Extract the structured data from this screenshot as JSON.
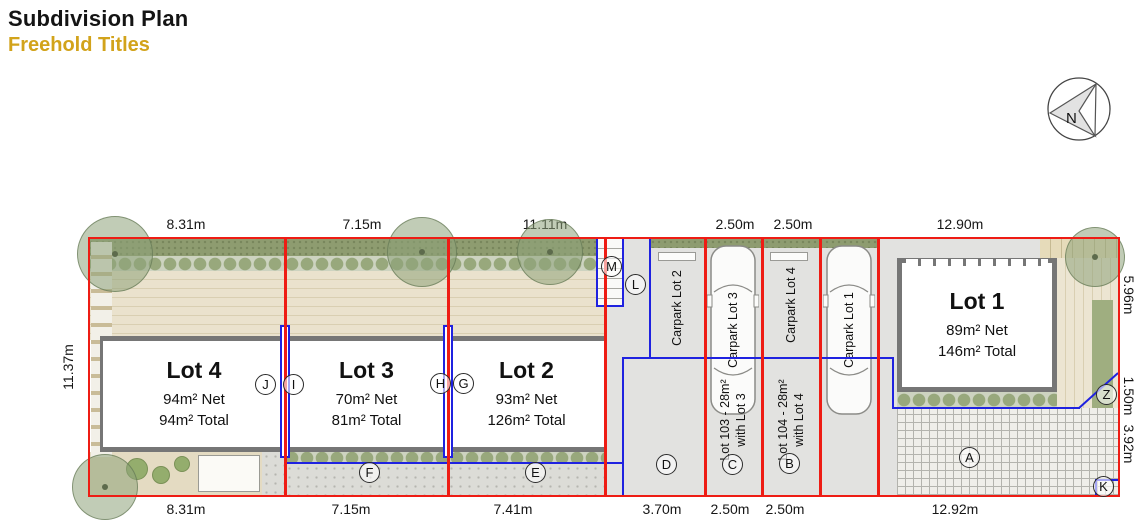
{
  "header": {
    "title": "Subdivision Plan",
    "subtitle": "Freehold Titles"
  },
  "compass": {
    "label": "N"
  },
  "dimensions": {
    "top": [
      "8.31m",
      "7.15m",
      "11.11m",
      "2.50m",
      "2.50m",
      "12.90m"
    ],
    "bottom": [
      "8.31m",
      "7.15m",
      "7.41m",
      "3.70m",
      "2.50m",
      "2.50m",
      "12.92m"
    ],
    "left": "11.37m",
    "right": [
      "5.96m",
      "1.50m",
      "3.92m"
    ]
  },
  "lots": {
    "lot4": {
      "name": "Lot 4",
      "net": "94m² Net",
      "total": "94m² Total"
    },
    "lot3": {
      "name": "Lot 3",
      "net": "70m² Net",
      "total": "81m² Total"
    },
    "lot2": {
      "name": "Lot 2",
      "net": "93m² Net",
      "total": "126m² Total"
    },
    "lot1": {
      "name": "Lot 1",
      "net": "89m² Net",
      "total": "146m² Total"
    }
  },
  "carparks": {
    "cp2": "Carpark Lot 2",
    "cp3": "Carpark Lot 3",
    "cp4": "Carpark Lot 4",
    "cp1": "Carpark Lot 1"
  },
  "accessory_lots": {
    "lot103": {
      "line1": "Lot 103 - 28m²",
      "line2": "with Lot 3"
    },
    "lot104": {
      "line1": "Lot 104 - 28m²",
      "line2": "with Lot 4"
    }
  },
  "markers": {
    "a": "A",
    "b": "B",
    "c": "C",
    "d": "D",
    "e": "E",
    "f": "F",
    "g": "G",
    "h": "H",
    "i": "I",
    "j": "J",
    "k": "K",
    "l": "L",
    "m": "M",
    "z": "Z"
  },
  "colors": {
    "boundary_red": "#ee1c14",
    "access_blue": "#1f22e0",
    "accent_gold": "#d2a31b"
  }
}
